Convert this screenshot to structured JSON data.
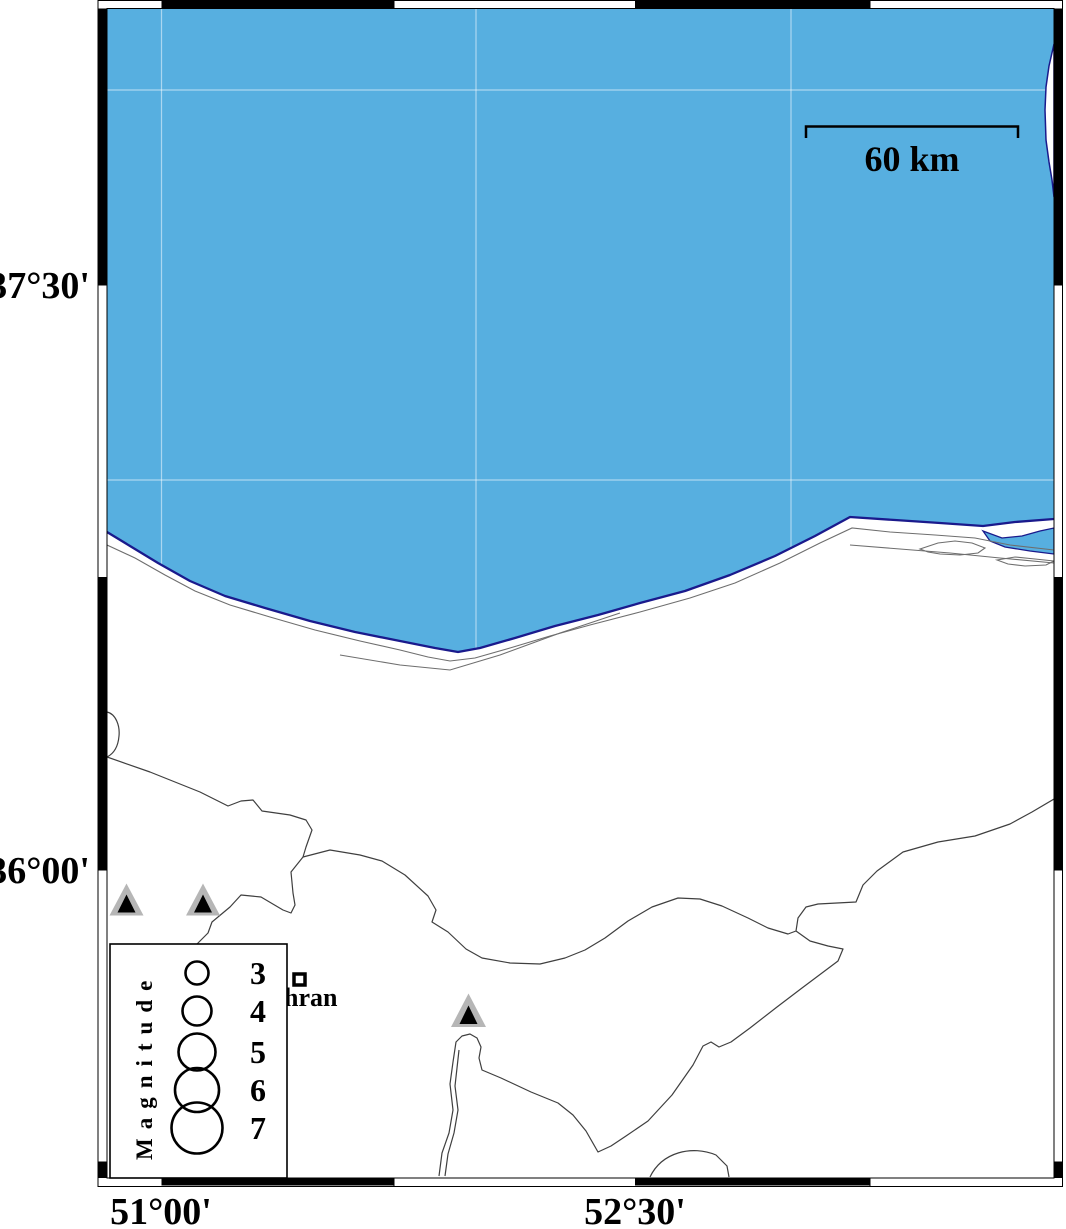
{
  "figure": {
    "description": "Seismicity map of the southern Caspian Sea coast with magnitude legend",
    "colors": {
      "sea": "#57AFE0",
      "coastline": "#1A1A8C",
      "land": "#FFFFFF",
      "boundary_line": "#3F3F3F",
      "coast_detail_line": "#6E6E6E",
      "volcano_fill": "#B6B6B6",
      "frame_black": "#000000"
    },
    "axes": {
      "left_labels": [
        "37°30'",
        "36°00'"
      ],
      "bottom_labels": [
        "51°00'",
        "52°30'"
      ]
    },
    "scale_bar": {
      "label": "60 km"
    },
    "legend": {
      "title": "Magnitude",
      "items": [
        {
          "magnitude": "3",
          "radius_px": 11.5
        },
        {
          "magnitude": "4",
          "radius_px": 14.5
        },
        {
          "magnitude": "5",
          "radius_px": 18.5
        },
        {
          "magnitude": "6",
          "radius_px": 22
        },
        {
          "magnitude": "7",
          "radius_px": 25.5
        }
      ]
    },
    "city": {
      "visible_label": "hran",
      "marker": "open-square"
    },
    "volcanoes": {
      "count": 3
    }
  }
}
